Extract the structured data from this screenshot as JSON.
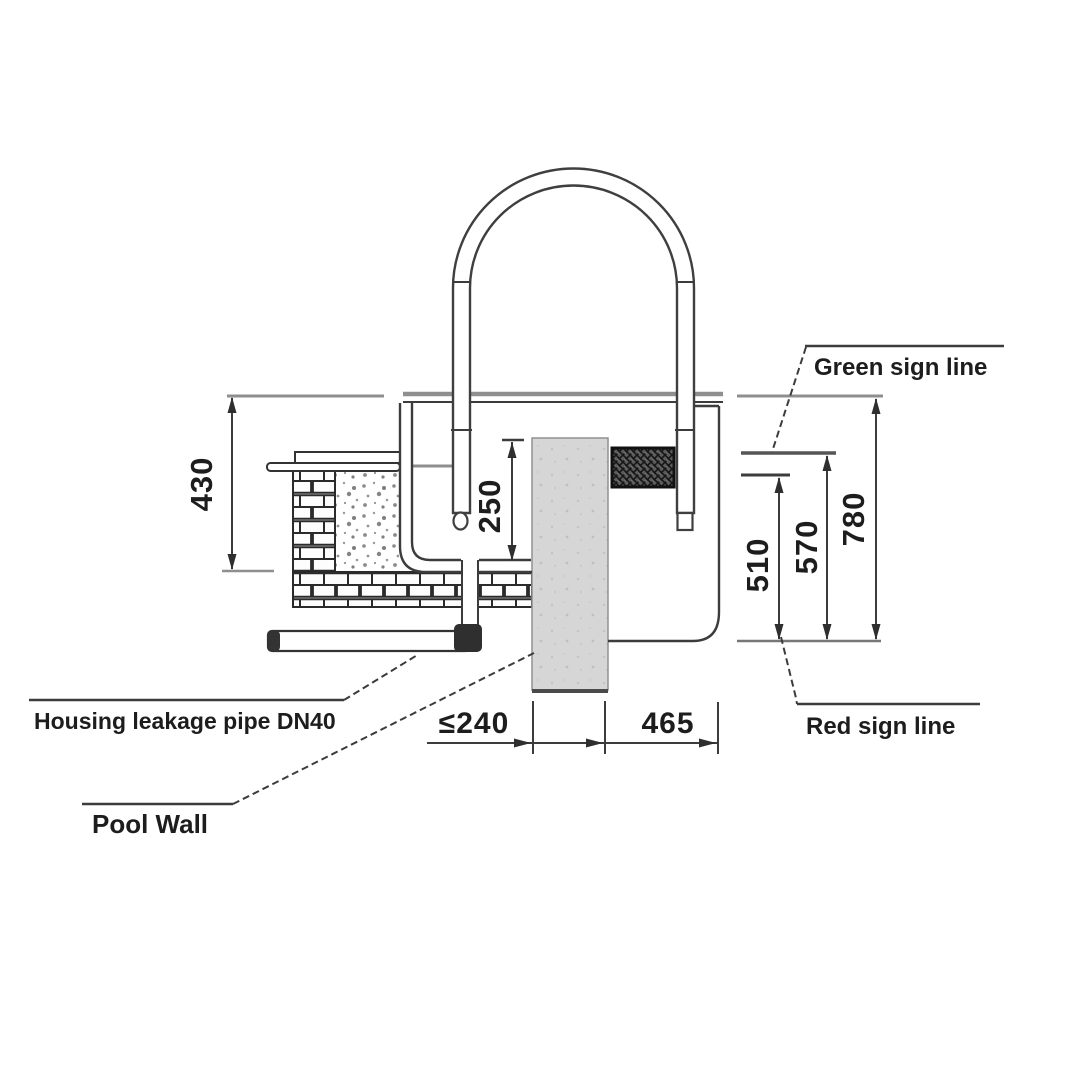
{
  "diagram": {
    "labels": {
      "green_sign_line": "Green sign line",
      "red_sign_line": "Red sign line",
      "housing_leakage_pipe": "Housing leakage pipe DN40",
      "pool_wall": "Pool Wall"
    },
    "dimensions": {
      "deck_to_housing_bottom": "430",
      "tube_insert_depth": "250",
      "red_to_lower_mark": "510",
      "red_to_green_mark": "570",
      "red_to_deck": "780",
      "wall_setback_max": "≤240",
      "wall_to_housing": "465"
    },
    "colors": {
      "line": "#3c3c3c",
      "reference_gray": "#8f8f8f",
      "pool_wall_fill": "#d6d6d6"
    }
  }
}
